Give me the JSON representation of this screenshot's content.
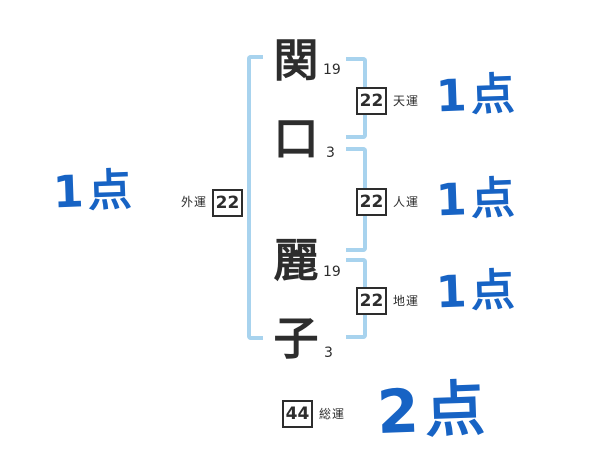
{
  "diagram": {
    "title": "seimei-handan stroke diagram",
    "name_characters": [
      {
        "char": "関",
        "strokes": "19"
      },
      {
        "char": "口",
        "strokes": "3"
      },
      {
        "char": "麗",
        "strokes": "19"
      },
      {
        "char": "子",
        "strokes": "3"
      }
    ],
    "heaven": {
      "value": "22",
      "label": "天運",
      "score": "1点"
    },
    "person": {
      "value": "22",
      "label": "人運",
      "score": "1点"
    },
    "earth": {
      "value": "22",
      "label": "地運",
      "score": "1点"
    },
    "outer": {
      "value": "22",
      "label": "外運",
      "score": "1点"
    },
    "total": {
      "value": "44",
      "label": "総運",
      "score": "2点"
    }
  },
  "colors": {
    "background": "#ffffff",
    "ink": "#2d2d2d",
    "bracket_blue": "#a8d3ee",
    "score_blue": "#1763c4"
  }
}
